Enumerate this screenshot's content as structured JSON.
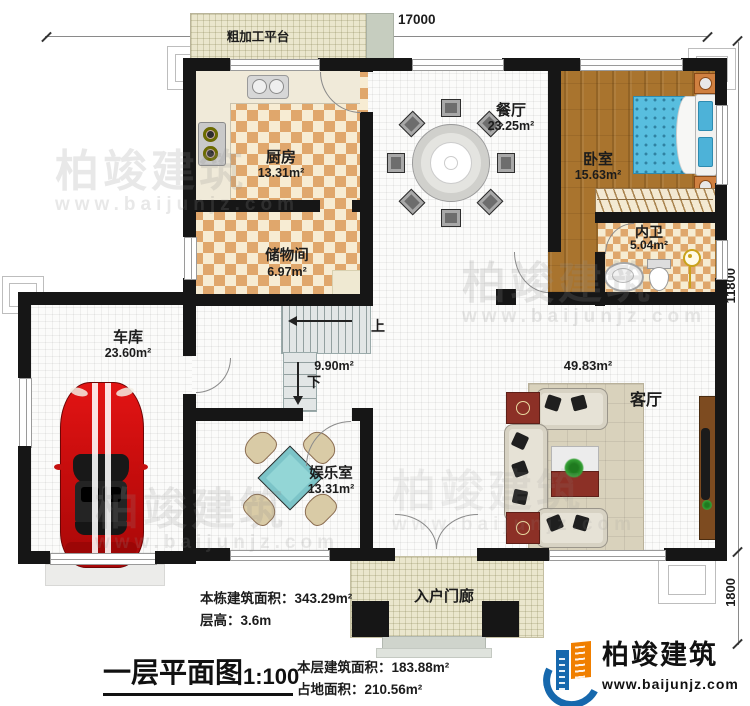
{
  "plan": {
    "title": "一层平面图",
    "scale": "1:100"
  },
  "dimensions": {
    "top_width": "17000",
    "right_height": "11800",
    "porch_depth": "1800"
  },
  "rooms": {
    "platform": {
      "label": "粗加工平台"
    },
    "kitchen": {
      "label": "厨房",
      "area": "13.31m²"
    },
    "storage": {
      "label": "储物间",
      "area": "6.97m²"
    },
    "dining": {
      "label": "餐厅",
      "area": "23.25m²"
    },
    "bedroom": {
      "label": "卧室",
      "area": "15.63m²"
    },
    "bathroom": {
      "label": "内卫",
      "area": "5.04m²"
    },
    "garage": {
      "label": "车库",
      "area": "23.60m²"
    },
    "entertainment": {
      "label": "娱乐室",
      "area": "13.31m²"
    },
    "living": {
      "label": "客厅",
      "area": "49.83m²"
    },
    "stairwell": {
      "area": "9.90m²",
      "up": "上",
      "down": "下"
    },
    "porch": {
      "label": "入户门廊"
    }
  },
  "footer": {
    "total_area": "本栋建筑面积：343.29m²",
    "floor_height": "层高：3.6m",
    "floor_area": "本层建筑面积：183.88m²",
    "footprint": "占地面积：210.56m²"
  },
  "brand": {
    "name": "柏竣建筑",
    "url": "www.baijunjz.com"
  },
  "watermark": {
    "name": "柏竣建筑",
    "url": "www.baijunjz.com"
  },
  "colors": {
    "wall": "#161616",
    "checker_dark": "#e0a76c",
    "checker_light": "#f7ecd3",
    "wood_floor": "#a9742e",
    "bed_blue": "#58bedf",
    "car_red": "#cf1212",
    "mahjong_cyan": "#93d6d6",
    "platform_beige": "#eae6cd",
    "logo_blue": "#1668ad",
    "logo_orange": "#f07f00"
  }
}
